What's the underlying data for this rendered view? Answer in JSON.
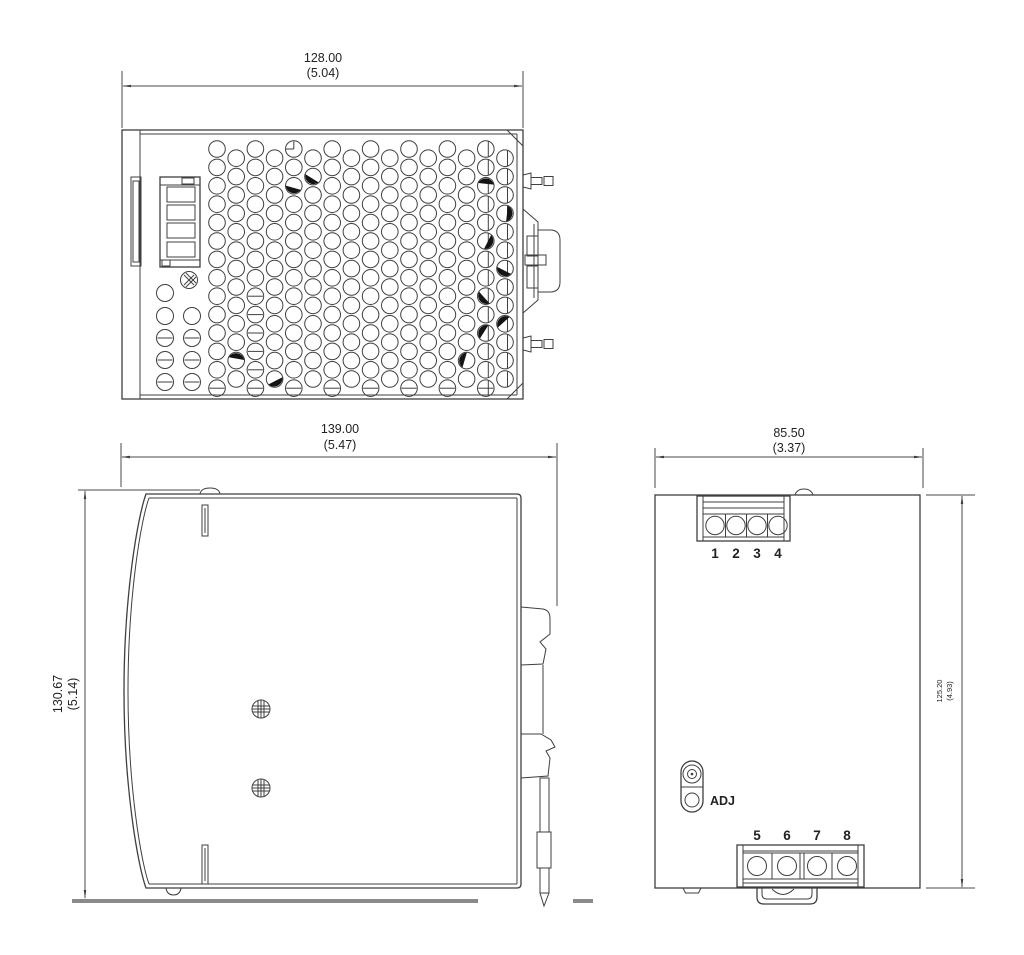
{
  "drawing": {
    "title": "power-supply-dimension-drawing",
    "top_view": {
      "width_mm": "128.00",
      "width_in": "(5.04)"
    },
    "side_view": {
      "width_mm": "139.00",
      "width_in": "(5.47)",
      "height_mm": "130.67",
      "height_in": "(5.14)"
    },
    "front_view": {
      "width_mm": "85.50",
      "width_in": "(3.37)",
      "height_mm": "125.20",
      "height_in": "(4.93)",
      "adj_label": "ADJ",
      "top_terminals": [
        "1",
        "2",
        "3",
        "4"
      ],
      "bottom_terminals": [
        "5",
        "6",
        "7",
        "8"
      ]
    }
  },
  "colors": {
    "line": "#3f3f3f",
    "text": "#222222",
    "rail": "#8a8a8a",
    "background": "#ffffff"
  }
}
